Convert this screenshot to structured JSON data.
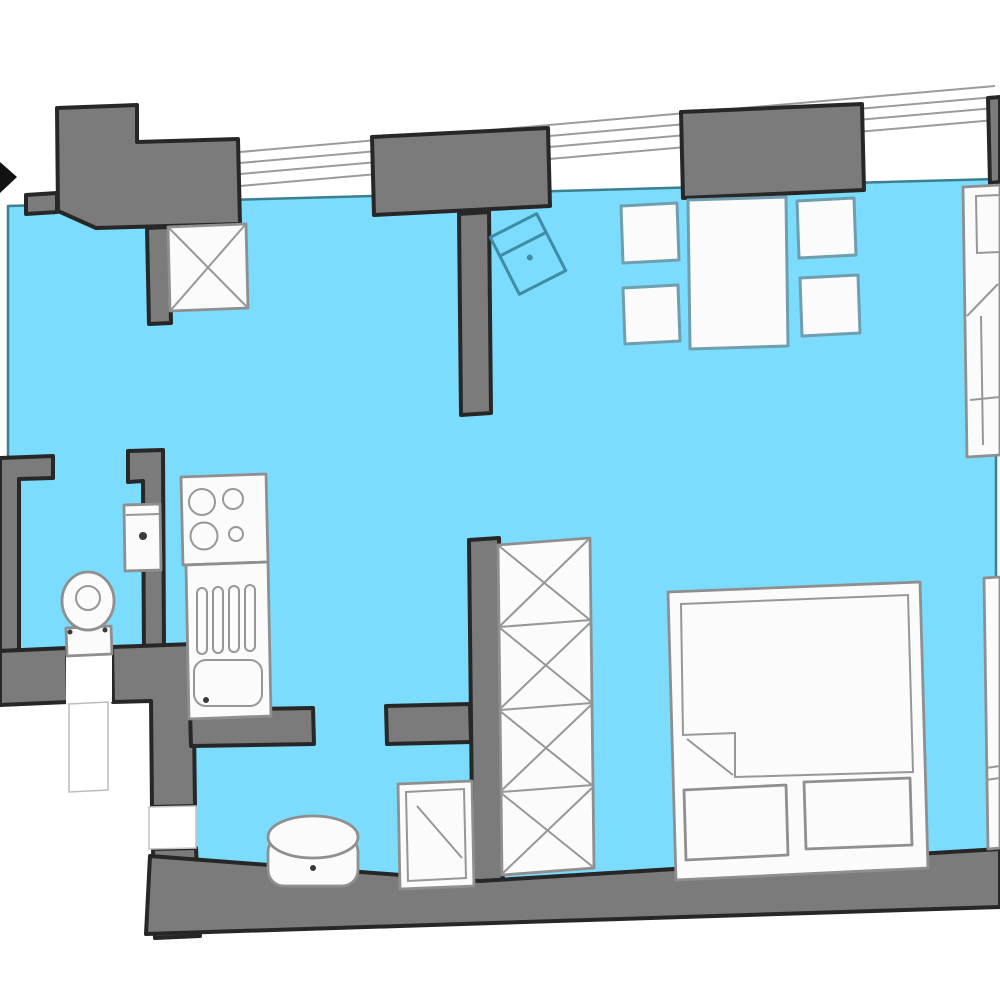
{
  "plan": {
    "kind": "apartment-floor-plan",
    "fixtures": [
      "entrance-arrow",
      "entrance-wall-block",
      "window-piers",
      "window-glazing-lines",
      "ventilation-shaft-x",
      "tilted-cabinet-outline",
      "dining-table",
      "dining-chairs",
      "couch-right-edge",
      "side-strip-cabinet",
      "double-bed",
      "pillows",
      "wardrobe-x-column",
      "shower-tray",
      "round-boiler",
      "toilet",
      "hand-basin",
      "stove-4-burners",
      "kitchen-sink-drainboard",
      "bathroom-walls",
      "bottom-outer-wall"
    ]
  },
  "colors": {
    "background": "#FFFFFF",
    "floor": "#7CDCFD",
    "floorBorder": "#3D7F8E",
    "wall": "#7B7B7B",
    "wallBorder": "#272727",
    "furniture": "#FBFBFB",
    "furnitureStroke": "#8F8F8F",
    "teal": "#6F9EAE",
    "cabinet": "#3E8CA6",
    "glaze": "#9B9B9B",
    "thin": "#979797",
    "arrow": "#121212"
  }
}
